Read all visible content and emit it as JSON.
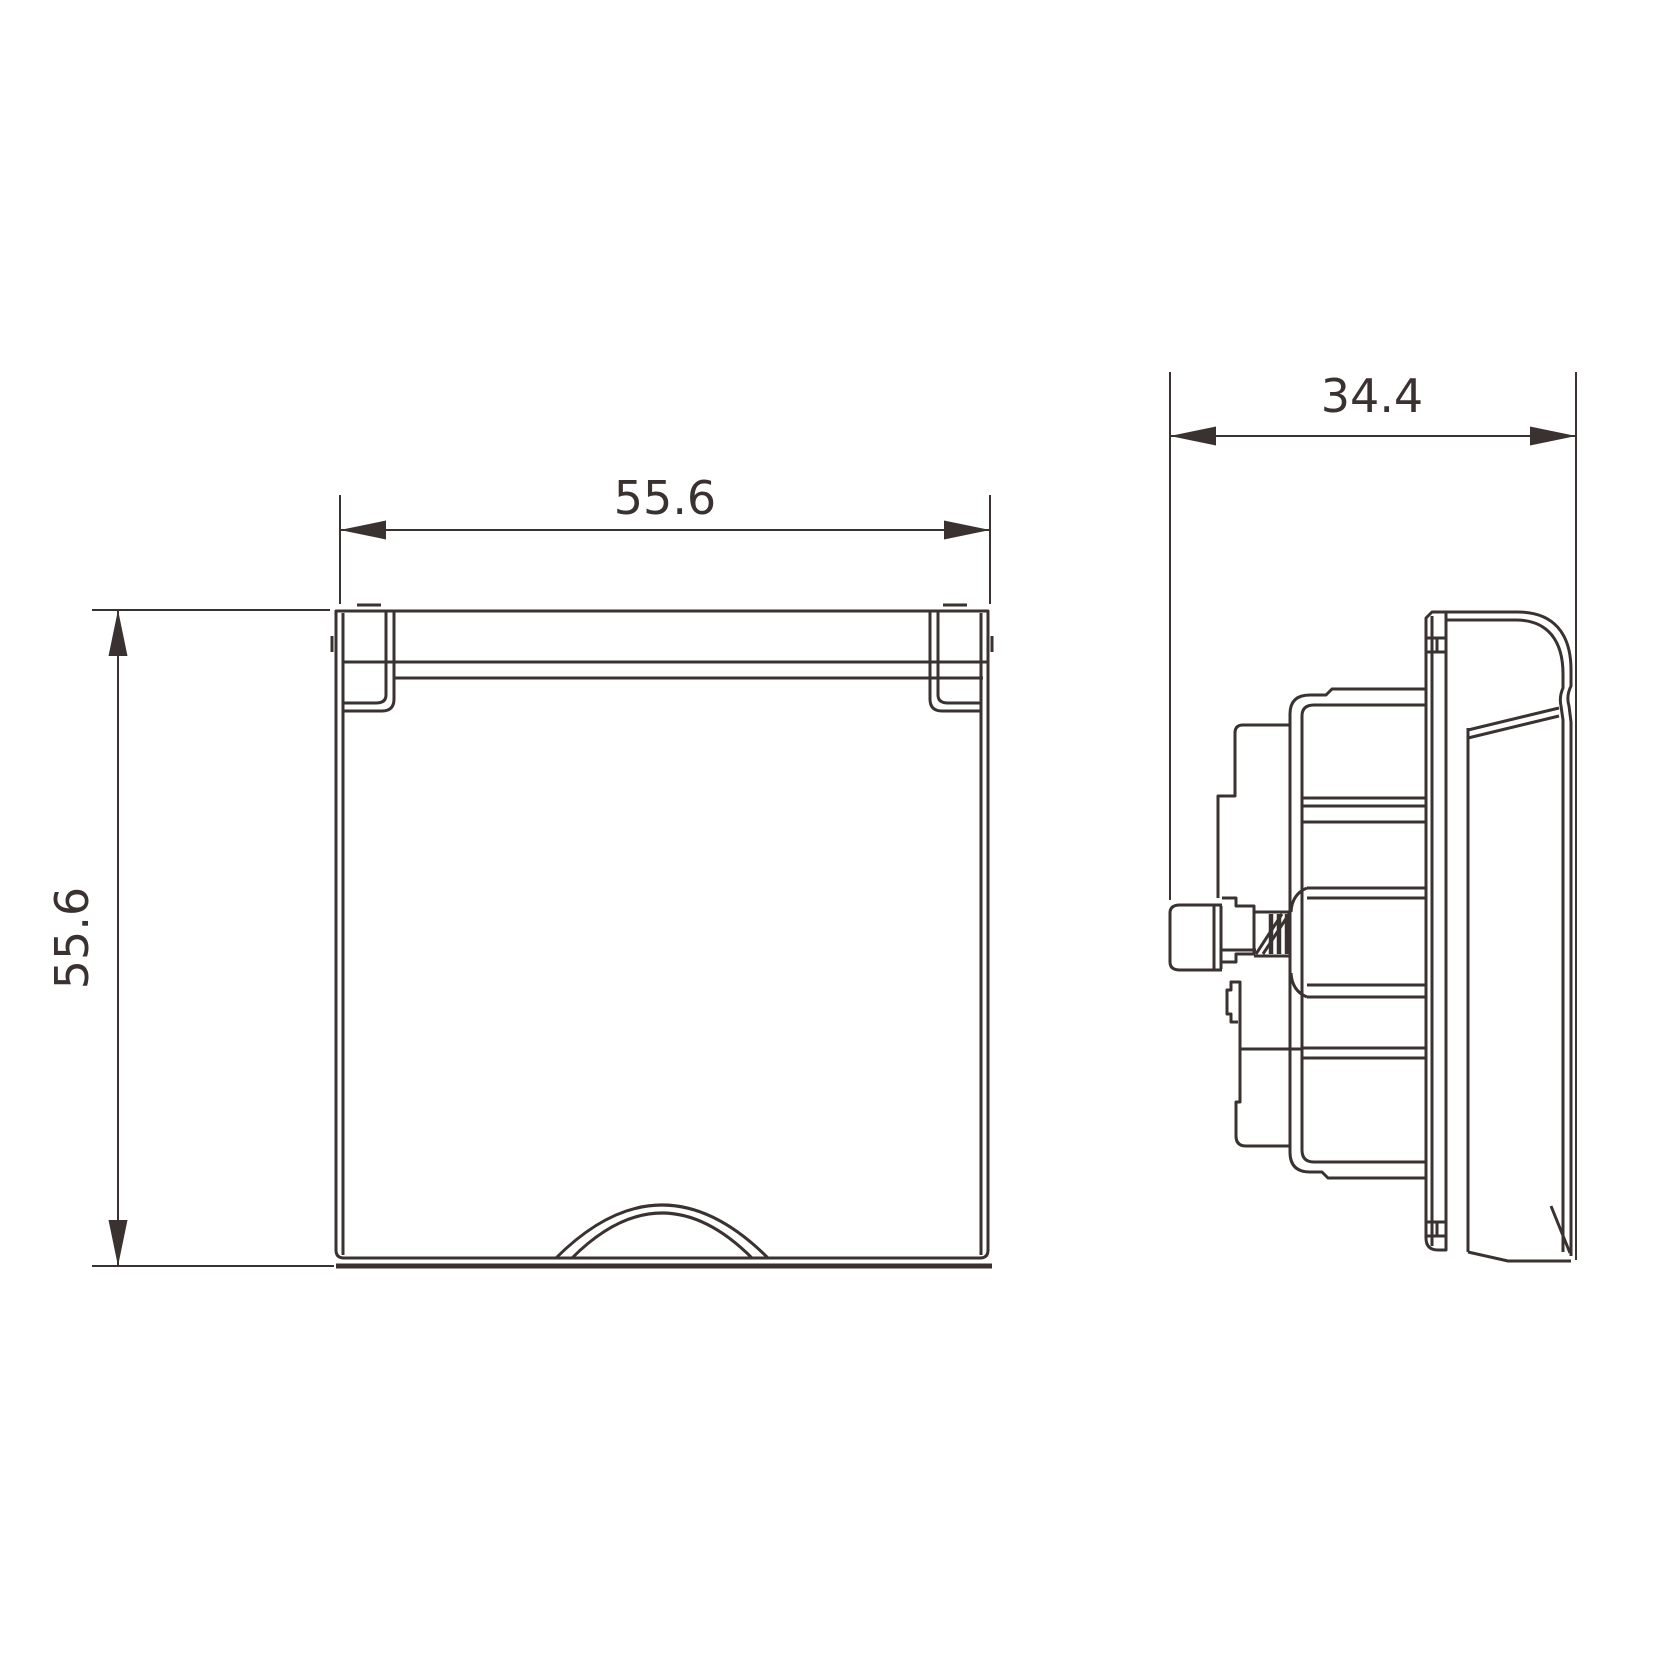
{
  "colors": {
    "line": "#3a3231",
    "background": "#ffffff"
  },
  "dimensions": {
    "front_width": {
      "value": "55.6"
    },
    "front_height": {
      "value": "55.6"
    },
    "side_depth": {
      "value": "34.4"
    }
  }
}
